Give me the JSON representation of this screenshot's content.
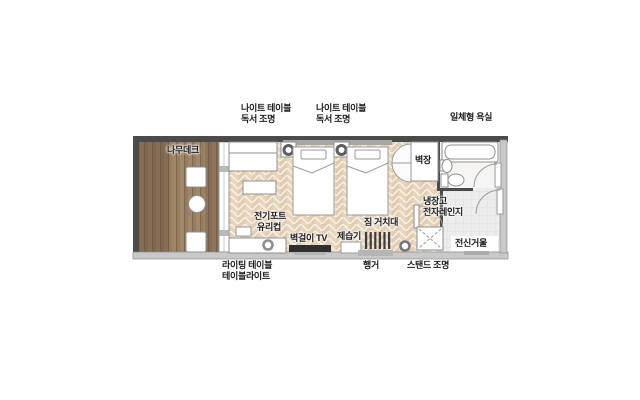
{
  "plan_title": "hotel room floor plan",
  "labels": {
    "night_table_1": {
      "line1": "나이트 테이블",
      "line2": "독서 조명"
    },
    "night_table_2": {
      "line1": "나이트 테이블",
      "line2": "독서 조명"
    },
    "bathroom": {
      "line1": "일체형 욕실"
    },
    "deck": {
      "line1": "나무데크"
    },
    "closet": {
      "line1": "벽장"
    },
    "fridge": {
      "line1": "냉장고",
      "line2": "전자레인지"
    },
    "kettle": {
      "line1": "전기포트",
      "line2": "유리컵"
    },
    "tv": {
      "line1": "벽걸이 TV"
    },
    "dehumidifier": {
      "line1": "제습기"
    },
    "luggage_rack": {
      "line1": "짐 거치대"
    },
    "writing_table": {
      "line1": "라이팅 테이블",
      "line2": "테이블라이트"
    },
    "hanger": {
      "line1": "행거"
    },
    "stand_lamp": {
      "line1": "스탠드 조명"
    },
    "mirror": {
      "line1": "전신거울"
    }
  },
  "colors": {
    "wall_dark": "#4b4b4b",
    "wall_light": "#c9c9c9",
    "floor_base": "#e8d5bd",
    "floor_seam": "#f8f1e6",
    "deck_wood": "#a1876a",
    "deck_wood_dark": "#6f5b44",
    "entry_floor": "#ededed",
    "bath_floor": "#f6f5f3",
    "furniture_outline": "#8f8f8f",
    "tv_screen": "#2f2f2f",
    "label_text": "#1c1c1c"
  }
}
